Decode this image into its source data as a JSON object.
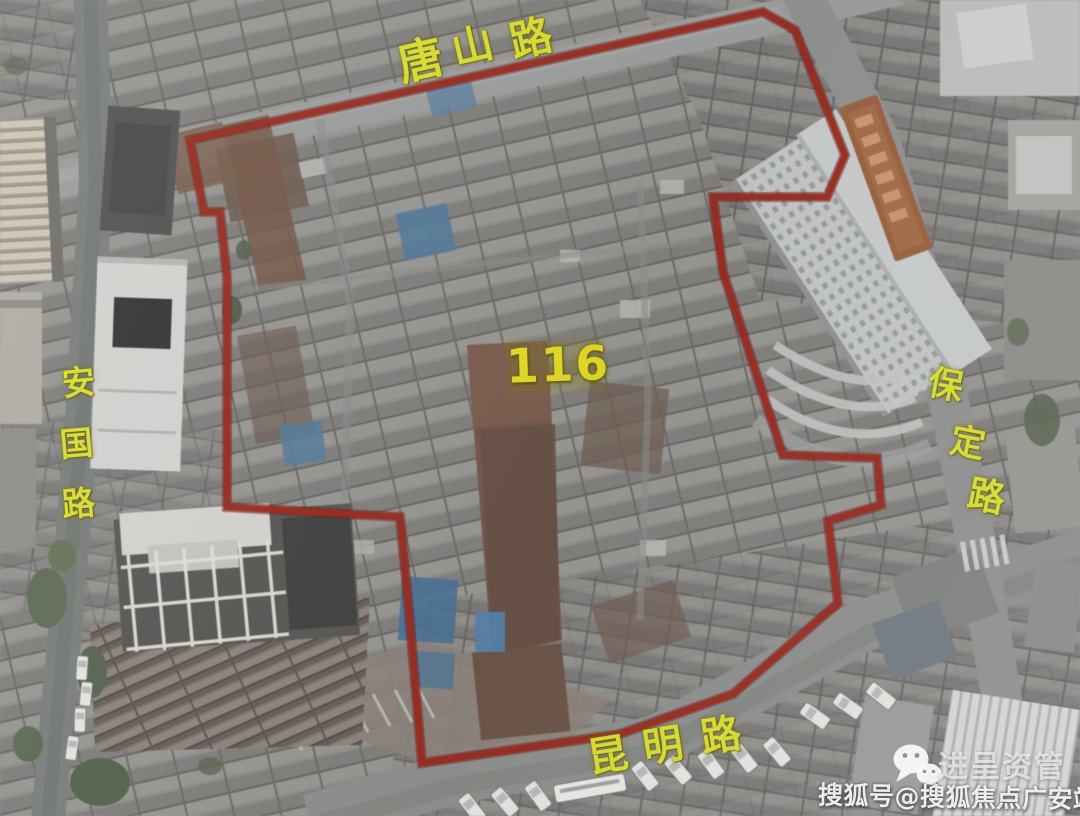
{
  "theme": {
    "boundary-red": "#a81f10",
    "label-yellow": "#dcdf2b",
    "label-yellow-bright": "#e6da1e",
    "watermark-white": "#f2f2ef"
  },
  "map": {
    "plot_label": "116",
    "roads": [
      {
        "name": "唐山路",
        "chars": [
          "唐",
          "山",
          "路"
        ]
      },
      {
        "name": "安国路",
        "chars": [
          "安",
          "国",
          "路"
        ]
      },
      {
        "name": "保定路",
        "chars": [
          "保",
          "定",
          "路"
        ]
      },
      {
        "name": "昆明路",
        "chars": [
          "昆",
          "明",
          "路"
        ]
      }
    ]
  },
  "watermark": {
    "icon": "wechat-icon",
    "brand": "进呈资管",
    "account": "搜狐号@搜狐焦点广安站"
  }
}
